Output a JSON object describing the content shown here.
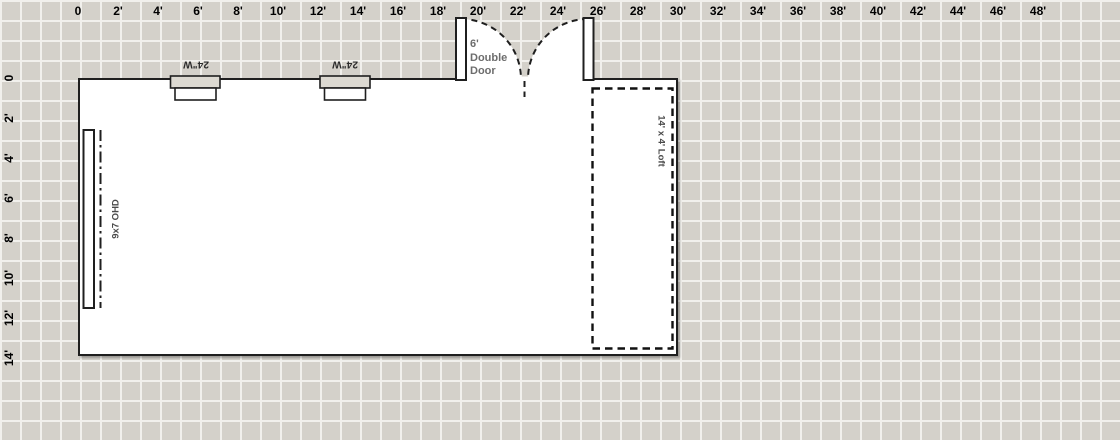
{
  "title": "Floor plan design canvas",
  "colors": {
    "grid_background": "#d4d1ca",
    "grid_line": "#f1f0ec",
    "wall": "#1f1f1f",
    "building_fill": "#ffffff",
    "window_frame_fill": "#dcd9d1",
    "ruler_label": "#000000",
    "window_label": "#2b2b2b",
    "feature_label": "#4a4a4a",
    "muted_label": "#6d6d6d"
  },
  "rulers": {
    "top": {
      "labels": [
        "0",
        "2'",
        "4'",
        "6'",
        "8'",
        "10'",
        "12'",
        "14'",
        "16'",
        "18'",
        "20'",
        "22'",
        "24'",
        "26'",
        "28'",
        "30'",
        "32'",
        "34'",
        "36'",
        "38'",
        "40'",
        "42'",
        "44'",
        "46'",
        "48'"
      ]
    },
    "left": {
      "labels": [
        "0",
        "2'",
        "4'",
        "6'",
        "8'",
        "10'",
        "12'",
        "14'"
      ]
    }
  },
  "features": {
    "windows": [
      {
        "label": "24\"W"
      },
      {
        "label": "24\"W"
      }
    ],
    "overhead_door": {
      "label": "9x7 OHD"
    },
    "double_door": {
      "label": "6'\nDouble\nDoor"
    },
    "loft": {
      "label": "14' x 4' Loft"
    }
  }
}
